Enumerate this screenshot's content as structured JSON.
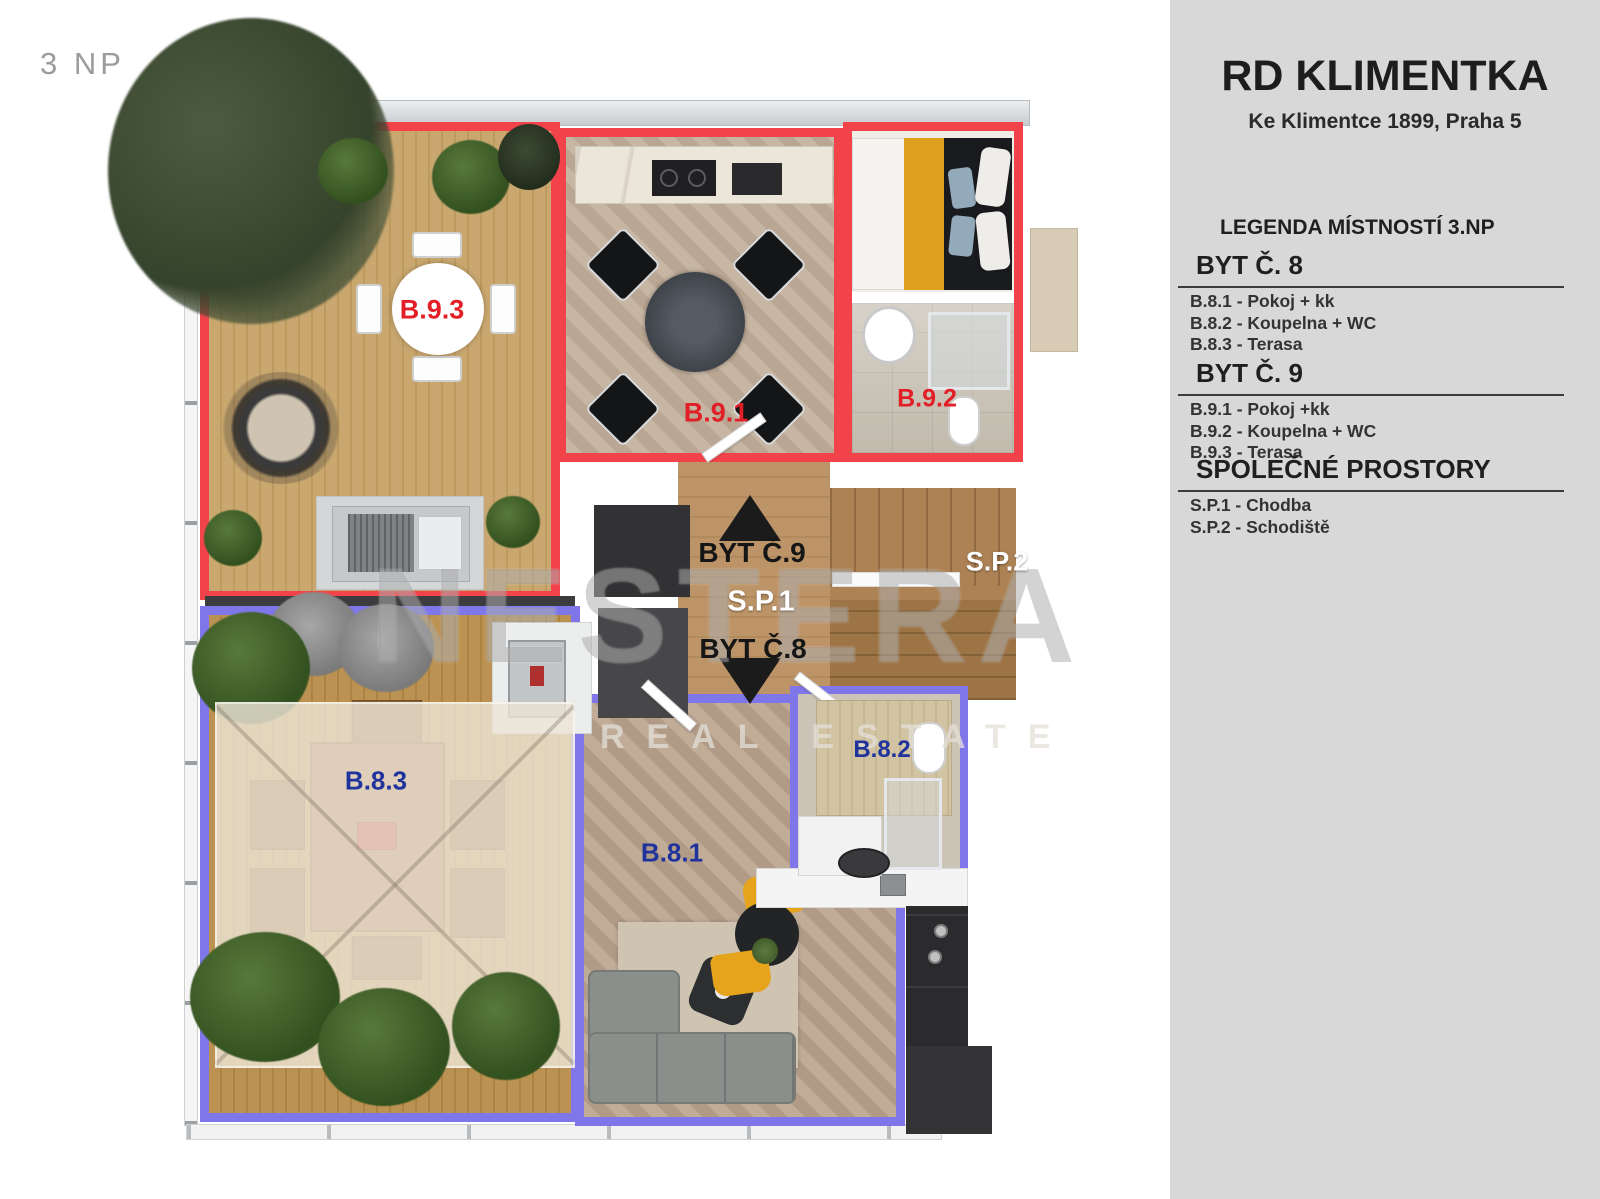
{
  "floor_label": "3 NP",
  "sidebar": {
    "title": "RD KLIMENTKA",
    "subtitle": "Ke Klimentce 1899, Praha 5",
    "legend_heading": "LEGENDA MÍSTNOSTÍ 3.NP",
    "sections": [
      {
        "heading": "BYT Č. 8",
        "items": [
          "B.8.1 - Pokoj + kk",
          "B.8.2 - Koupelna + WC",
          "B.8.3 - Terasa"
        ]
      },
      {
        "heading": "BYT Č. 9",
        "items": [
          "B.9.1 - Pokoj +kk",
          "B.9.2 - Koupelna + WC",
          "B.9.3 - Terasa"
        ]
      },
      {
        "heading": "SPOLEČNÉ PROSTORY",
        "items": [
          "S.P.1 - Chodba",
          "S.P.2 - Schodiště"
        ]
      }
    ]
  },
  "plan": {
    "labels": {
      "b93": "B.9.3",
      "b91": "B.9.1",
      "b92": "B.9.2",
      "b83": "B.8.3",
      "b81": "B.8.1",
      "b82": "B.8.2",
      "sp1": "S.P.1",
      "sp2": "S.P.2",
      "byt9": "BYT Č.9",
      "byt8": "BYT Č.8"
    },
    "watermark": {
      "line1": "NESTERA",
      "line2": "REAL ESTATE"
    },
    "colors": {
      "byt9_outline": "#f2434b",
      "byt8_outline": "#7f77e9",
      "label_red": "#e21e26",
      "label_blue": "#20339c"
    }
  }
}
